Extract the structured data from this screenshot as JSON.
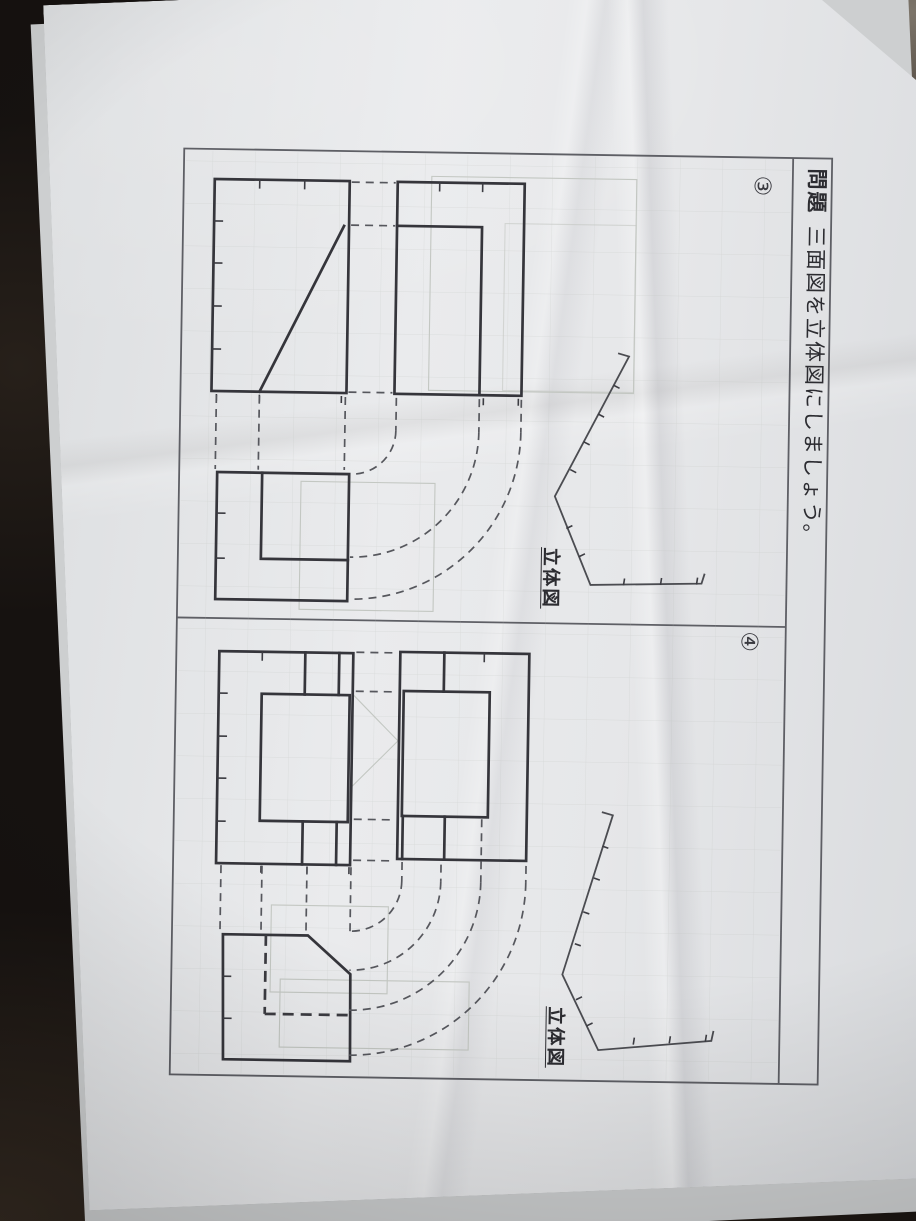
{
  "header": {
    "problem_label": "問題",
    "instruction": "三面図を立体図にしましょう。"
  },
  "problems": [
    {
      "number": "③",
      "figure_label": "立体図"
    },
    {
      "number": "④",
      "figure_label": "立体図"
    }
  ]
}
